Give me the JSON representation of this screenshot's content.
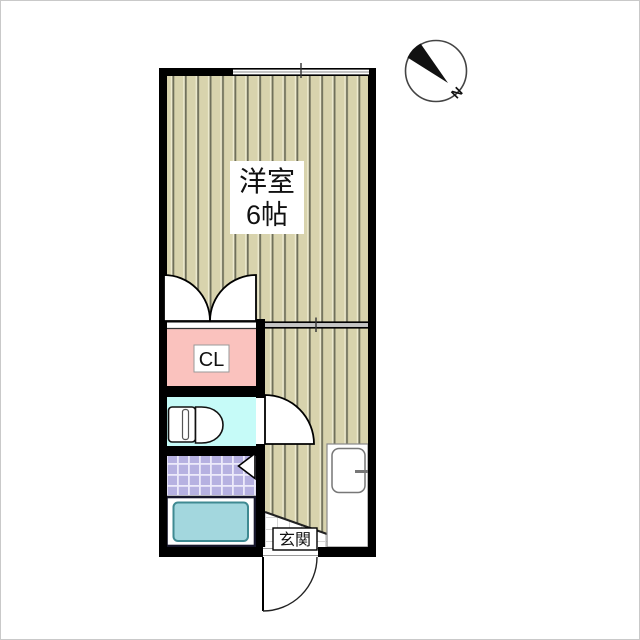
{
  "plan": {
    "type": "apartment-floor-plan",
    "rooms": {
      "main_room": {
        "name_line1": "洋室",
        "name_line2": "6帖"
      },
      "closet": {
        "label": "CL"
      },
      "entrance": {
        "label": "玄関"
      }
    },
    "compass": {
      "label": "N"
    },
    "colors": {
      "wall": "#000000",
      "floor_wood": "#d8d3ad",
      "floor_stripe": "#70705b",
      "closet_fill": "#fac2be",
      "toilet_fill": "#c6fbf8",
      "bath_tile": "#b6b1e1",
      "bathtub_fill": "#a3d7de",
      "bathtub_edge": "#3f8a92",
      "genkan_tile_line": "#d5d5d5"
    }
  }
}
